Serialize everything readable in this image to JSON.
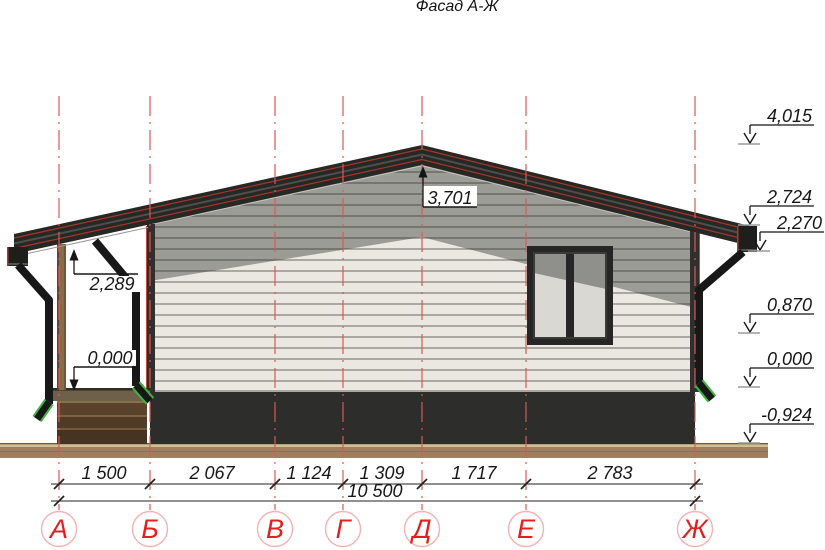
{
  "title": "Фасад А-Ж",
  "axes": {
    "labels": [
      "А",
      "Б",
      "В",
      "Г",
      "Д",
      "Е",
      "Ж"
    ]
  },
  "dimensions": {
    "row1": [
      "1 500",
      "2 067",
      "1 124",
      "1 309",
      "1 717",
      "2 783"
    ],
    "total": "10 500"
  },
  "elevations": {
    "right": [
      "4,015",
      "2,724",
      "2,270",
      "0,870",
      "0,000",
      "-0,924"
    ],
    "ridge": "3,701",
    "porch_ceiling": "2,289",
    "porch_floor": "0,000"
  },
  "colors": {
    "axis_red_dashed": "#e05555",
    "bubble_letter_red": "#e41f1f",
    "bubble_circle_pink": "#f5b2b2",
    "roof_dark": "#272726",
    "roof_membrane_red": "#a03828",
    "wall_cream": "#eae8e0",
    "gable_shadow_gray": "#9c9c97",
    "plinth_dark": "#2d2d2b",
    "ground_brown": "#a07f60",
    "wood_post_brown": "#8a6a48",
    "downspout_black": "#181818",
    "drain_elbow_green": "#3cb53c",
    "window_frame_dark": "#262626",
    "glass_light": "#d9d8d3",
    "glass_shade": "#8f8f8c"
  }
}
